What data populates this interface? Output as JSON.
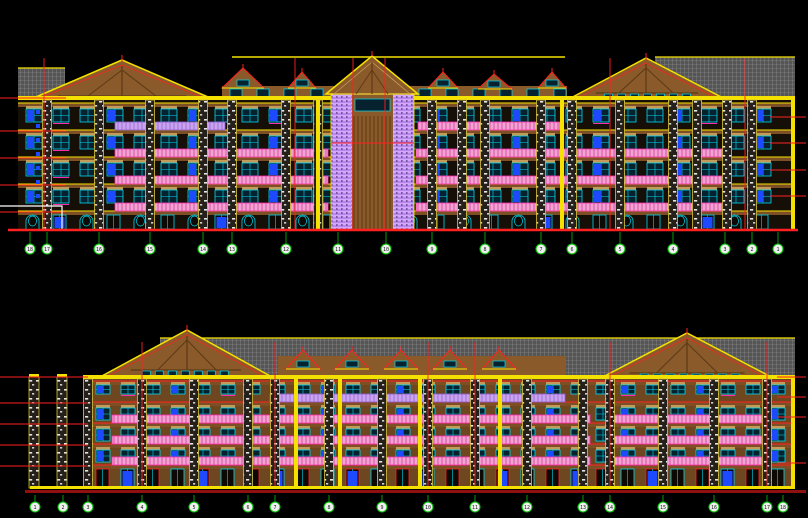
{
  "document": {
    "kind": "cad-elevation-drawing",
    "views": [
      "upper-elevation",
      "lower-elevation"
    ]
  },
  "drawing": {
    "width": 808,
    "height": 518,
    "colors": {
      "background": "#000000",
      "yellow": "#f5e100",
      "red": "#ff2020",
      "dark_red": "#8f1010",
      "roof_brown": "#8a5a2a",
      "timber": "#5e3a16",
      "tan": "#c49a58",
      "slab": "#7c4f24",
      "wall_upper": "#160f08",
      "wall_lower": "#6e4720",
      "cyan": "#00d8f0",
      "blue": "#1d49ff",
      "magenta": "#ff2bb0",
      "violet_stroke": "#8d5cc9",
      "green": "#00c000",
      "green_dark": "#0a9a0a",
      "white": "#ffffff",
      "pier_edge": "#d8c23a",
      "glass_dark": "#06222e",
      "door_dark": "#0d0a05"
    },
    "upper": {
      "baseline": {
        "x1": 8,
        "x2": 798,
        "y": 230
      },
      "facade": {
        "x1": 18,
        "x2": 795,
        "top": 100,
        "floor_lines": [
          104,
          131,
          158,
          185,
          212,
          230
        ]
      },
      "attic_band": {
        "x": 222,
        "y": 86,
        "w": 345,
        "h": 18
      },
      "ridge": {
        "y": 57,
        "x1": 232,
        "x2": 565
      },
      "hatches": [
        [
          18,
          68,
          47,
          33
        ],
        [
          655,
          57,
          140,
          43
        ]
      ],
      "gables": [
        {
          "apex": [
            122,
            60
          ],
          "left": [
            22,
            103
          ],
          "right": [
            222,
            103
          ]
        },
        {
          "apex": [
            646,
            58
          ],
          "left": [
            567,
            100
          ],
          "right": [
            727,
            100
          ]
        }
      ],
      "tower": {
        "x1": 331,
        "x2": 414,
        "roof": {
          "apex": [
            372,
            56
          ],
          "left": [
            326,
            94
          ],
          "right": [
            418,
            94
          ]
        },
        "red_band_y": 143
      },
      "dormers": [
        {
          "apex": [
            243,
            68
          ],
          "l": 222,
          "r": 264,
          "e": 88
        },
        {
          "apex": [
            302,
            72
          ],
          "l": 288,
          "r": 316,
          "e": 88
        },
        {
          "apex": [
            443,
            72
          ],
          "l": 428,
          "r": 458,
          "e": 88
        },
        {
          "apex": [
            494,
            74
          ],
          "l": 478,
          "r": 512,
          "e": 89
        },
        {
          "apex": [
            552,
            72
          ],
          "l": 538,
          "r": 566,
          "e": 88
        }
      ],
      "piers": [
        47,
        99,
        150,
        203,
        232,
        286,
        318,
        432,
        462,
        485,
        541,
        572,
        620,
        673,
        697,
        727,
        752
      ],
      "yellow_columns": [
        318,
        562,
        793
      ],
      "red_verticals": [
        44,
        295,
        353,
        385,
        610,
        745
      ],
      "rails": [
        {
          "f": 0,
          "x1": 115,
          "x2": 225,
          "type": "violet"
        },
        {
          "f": 0,
          "x1": 418,
          "x2": 560,
          "type": "pink"
        },
        {
          "f": 1,
          "x1": 115,
          "x2": 328,
          "type": "pink"
        },
        {
          "f": 1,
          "x1": 416,
          "x2": 727,
          "type": "pink"
        },
        {
          "f": 2,
          "x1": 115,
          "x2": 328,
          "type": "pink"
        },
        {
          "f": 2,
          "x1": 416,
          "x2": 727,
          "type": "pink"
        },
        {
          "f": 3,
          "x1": 115,
          "x2": 328,
          "type": "pink"
        },
        {
          "f": 3,
          "x1": 416,
          "x2": 727,
          "type": "pink"
        }
      ],
      "level_ticks_left": {
        "x1": 0,
        "x2": 66,
        "ys": [
          98,
          131,
          158,
          185,
          212
        ]
      },
      "level_ticks_right": {
        "x1": 770,
        "x2": 806,
        "ys": [
          117,
          143,
          170,
          196
        ]
      },
      "section_mark": [
        [
          0,
          206
        ],
        [
          62,
          206
        ],
        [
          62,
          230
        ]
      ],
      "blue_ticks": {
        "x": 36,
        "ys": [
          110,
          124,
          138,
          152,
          166,
          180,
          194
        ]
      },
      "window": {
        "start": 26,
        "step": 27,
        "w": 16,
        "h": 13,
        "arch_doors": true
      },
      "bubbles": {
        "y": 249,
        "xs": [
          30,
          47,
          99,
          150,
          203,
          232,
          286,
          338,
          386,
          432,
          485,
          541,
          572,
          620,
          673,
          725,
          752,
          778
        ],
        "labels": [
          "18",
          "17",
          "16",
          "15",
          "14",
          "13",
          "12",
          "11",
          "10",
          "9",
          "8",
          "7",
          "6",
          "5",
          "4",
          "3",
          "2",
          "1"
        ]
      }
    },
    "lower": {
      "baseline_yellow": {
        "x": 30,
        "y": 486,
        "w": 765,
        "h": 3
      },
      "baseline_red": {
        "x": 25,
        "y": 490,
        "w": 781,
        "h": 3
      },
      "baseline": {
        "y": 489
      },
      "facade": {
        "x1": 83,
        "x2": 795,
        "top": 379,
        "floor_lines": [
          382,
          403,
          424,
          445,
          466,
          488
        ]
      },
      "hatch_band": [
        160,
        338,
        635,
        37
      ],
      "fascia": {
        "x": 88,
        "y": 375,
        "w": 707,
        "h": 4
      },
      "gables": [
        {
          "apex": [
            187,
            330
          ],
          "left": [
            100,
            377
          ],
          "right": [
            272,
            377
          ]
        },
        {
          "apex": [
            687,
            333
          ],
          "left": [
            597,
            380
          ],
          "right": [
            777,
            380
          ]
        }
      ],
      "dormer_band": {
        "x": 278,
        "y": 356,
        "w": 288,
        "h": 20
      },
      "dormers": [
        {
          "apex": [
            303,
            350
          ],
          "l": 286,
          "r": 320,
          "e": 369
        },
        {
          "apex": [
            352,
            350
          ],
          "l": 335,
          "r": 369,
          "e": 369
        },
        {
          "apex": [
            401,
            350
          ],
          "l": 384,
          "r": 418,
          "e": 369
        },
        {
          "apex": [
            450,
            350
          ],
          "l": 433,
          "r": 467,
          "e": 369
        },
        {
          "apex": [
            499,
            350
          ],
          "l": 482,
          "r": 516,
          "e": 369
        }
      ],
      "piers": [
        88,
        142,
        194,
        248,
        275,
        329,
        382,
        428,
        475,
        527,
        583,
        610,
        663,
        714,
        767
      ],
      "standalone_piers": [
        34,
        62
      ],
      "yellow_columns": [
        296,
        340,
        420,
        500,
        793
      ],
      "red_verticals": [
        142,
        275,
        428,
        475,
        610,
        767
      ],
      "rails": [
        {
          "f": 0,
          "x1": 270,
          "x2": 565,
          "type": "violet"
        },
        {
          "f": 1,
          "x1": 112,
          "x2": 590,
          "type": "pink"
        },
        {
          "f": 1,
          "x1": 610,
          "x2": 762,
          "type": "pink"
        },
        {
          "f": 2,
          "x1": 112,
          "x2": 590,
          "type": "pink"
        },
        {
          "f": 2,
          "x1": 610,
          "x2": 762,
          "type": "pink"
        },
        {
          "f": 3,
          "x1": 112,
          "x2": 590,
          "type": "pink"
        },
        {
          "f": 3,
          "x1": 610,
          "x2": 762,
          "type": "pink"
        }
      ],
      "level_ticks_left": {
        "x1": 0,
        "x2": 88,
        "ys": [
          377,
          403,
          424,
          445,
          466
        ]
      },
      "level_ticks_right": {
        "x1": 777,
        "x2": 806,
        "ys": [
          377,
          397,
          417,
          463
        ]
      },
      "window": {
        "start": 96,
        "step": 25,
        "w": 14,
        "h": 12,
        "small_top": true,
        "arch_doors": false
      },
      "bubbles": {
        "y": 507,
        "xs": [
          35,
          63,
          88,
          142,
          194,
          248,
          275,
          329,
          382,
          428,
          475,
          527,
          583,
          610,
          663,
          714,
          767,
          783
        ],
        "labels": [
          "1",
          "2",
          "3",
          "4",
          "5",
          "6",
          "7",
          "8",
          "9",
          "10",
          "11",
          "12",
          "13",
          "14",
          "15",
          "16",
          "17",
          "18"
        ]
      }
    }
  }
}
